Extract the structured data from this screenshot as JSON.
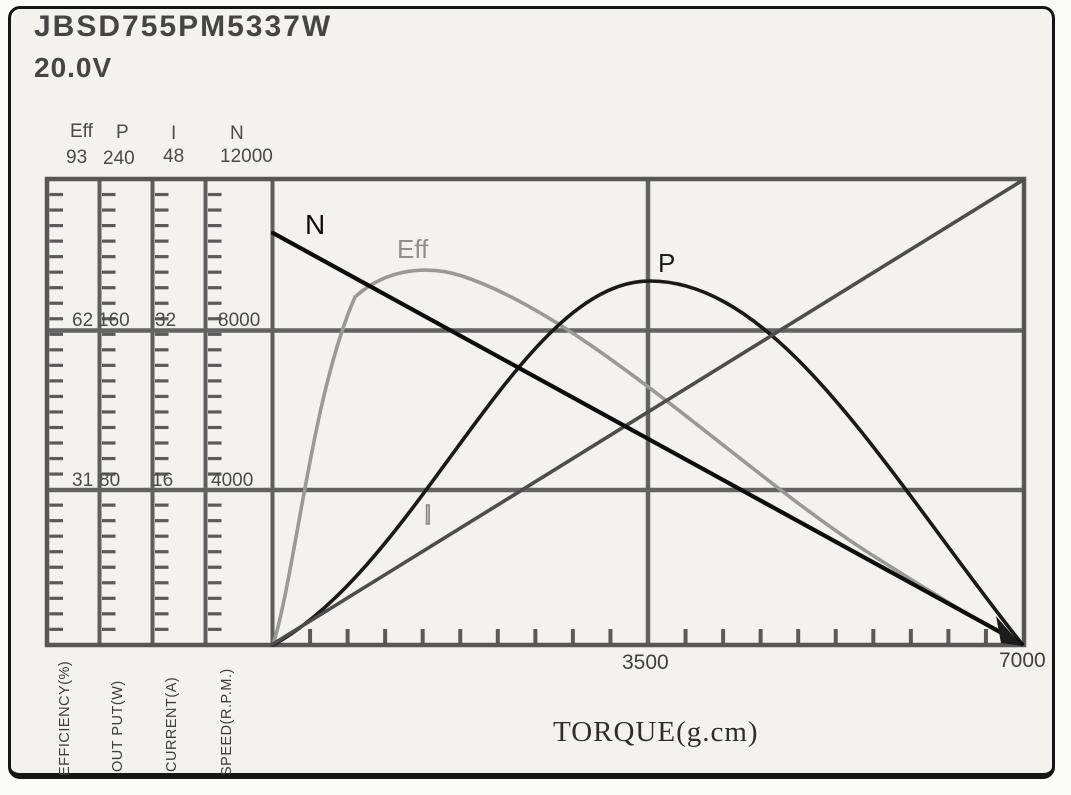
{
  "window": {
    "title_model": "JBSD755PM5337W",
    "title_voltage": "20.0V"
  },
  "axes": {
    "left_columns": [
      {
        "name": "Eff",
        "max": "93",
        "mid": "62",
        "low": "31",
        "unit": "EFFICIENCY(%)"
      },
      {
        "name": "P",
        "max": "240",
        "mid": "160",
        "low": "80",
        "unit": "OUT PUT(W)"
      },
      {
        "name": "I",
        "max": "48",
        "mid": "32",
        "low": "16",
        "unit": "CURRENT(A)"
      },
      {
        "name": "N",
        "max": "12000",
        "mid": "8000",
        "low": "4000",
        "unit": "SPEED(R.P.M.)"
      }
    ],
    "x_axis": {
      "title": "TORQUE(g.cm)",
      "mid_tick": "3500",
      "max_tick": "7000"
    }
  },
  "curve_labels": {
    "n": "N",
    "eff": "Eff",
    "p": "P",
    "i": "I"
  },
  "colors": {
    "n_curve": "#0d0d0d",
    "eff_curve": "#999999",
    "p_curve": "#1a1a1a",
    "i_curve": "#4d4d4d",
    "grid": "#5f5f5f",
    "text": "#3d3d3d",
    "frame_border": "#151515"
  },
  "chart_data": {
    "type": "line",
    "title": "JBSD755PM5337W 20.0V motor performance curves",
    "xlabel": "TORQUE(g.cm)",
    "x_range": [
      0,
      7000
    ],
    "x_ticks_labeled": [
      "3500",
      "7000"
    ],
    "grid": true,
    "legend_position": "labels-on-curves",
    "x": [
      0,
      500,
      1000,
      1500,
      2000,
      2500,
      3000,
      3500,
      4000,
      4500,
      5000,
      5500,
      6000,
      6500,
      7000
    ],
    "series": [
      {
        "name": "N",
        "unit": "SPEED(R.P.M.)",
        "axis_max": 12000,
        "axis_ticks": [
          4000,
          8000,
          12000
        ],
        "color": "#0d0d0d",
        "values": [
          10550,
          9800,
          9040,
          8290,
          7540,
          6780,
          6030,
          5280,
          4520,
          3770,
          3010,
          2260,
          1510,
          750,
          0
        ]
      },
      {
        "name": "Eff",
        "unit": "EFFICIENCY(%)",
        "axis_max": 93,
        "axis_ticks": [
          31,
          62,
          93
        ],
        "color": "#999999",
        "values": [
          0,
          35,
          69,
          74,
          72,
          66,
          58,
          50,
          41,
          33,
          28,
          21,
          12,
          6,
          0
        ]
      },
      {
        "name": "P",
        "unit": "OUT PUT(W)",
        "axis_max": 240,
        "axis_ticks": [
          80,
          160,
          240
        ],
        "color": "#1a1a1a",
        "values": [
          0,
          50,
          92,
          126,
          153,
          172,
          183,
          187,
          183,
          172,
          153,
          126,
          92,
          50,
          0
        ]
      },
      {
        "name": "I",
        "unit": "CURRENT(A)",
        "axis_max": 48,
        "axis_ticks": [
          16,
          32,
          48
        ],
        "color": "#4d4d4d",
        "values": [
          0,
          3.4,
          6.9,
          10.3,
          13.7,
          17.1,
          20.6,
          24,
          27.4,
          30.9,
          34.3,
          37.7,
          41.1,
          44.6,
          48
        ]
      }
    ]
  }
}
